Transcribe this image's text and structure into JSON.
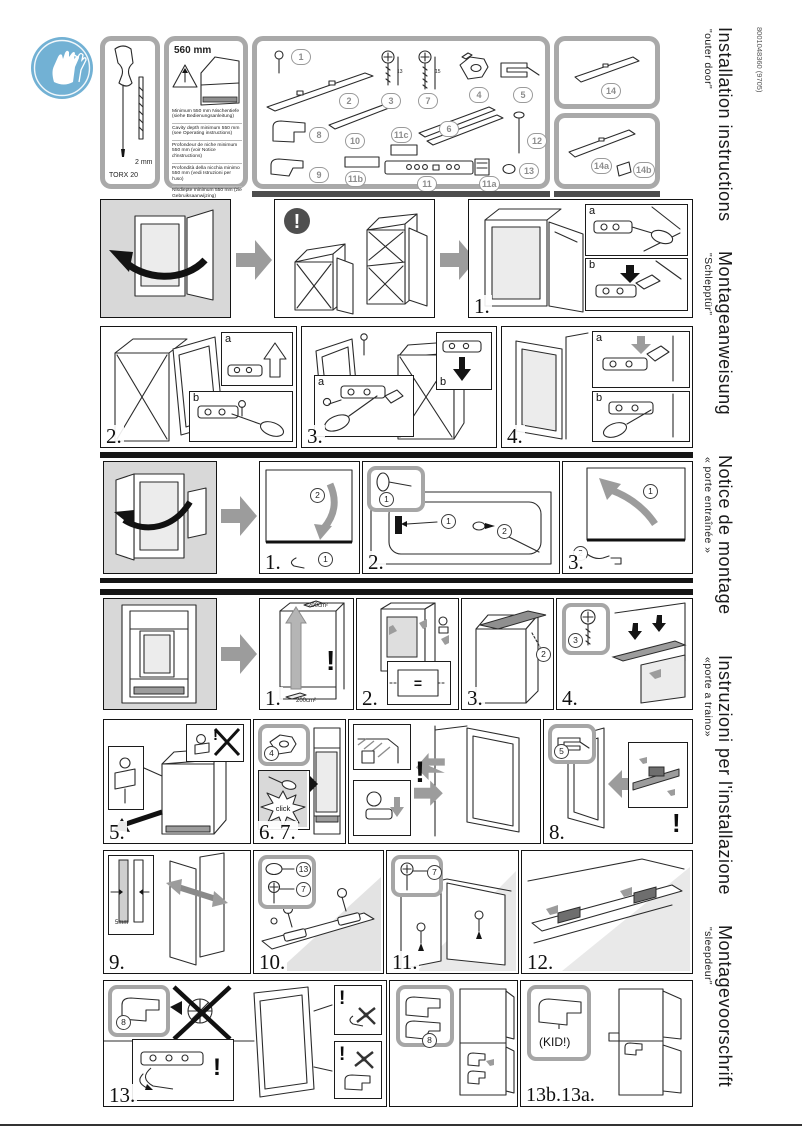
{
  "page": {
    "code": "8001048360 (9705)"
  },
  "side_titles": [
    {
      "title": "Installation instructions",
      "subtitle": "\"outer door\""
    },
    {
      "title": "Montageanweisung",
      "subtitle": "\"Schlepptür\""
    },
    {
      "title": "Notice de montage",
      "subtitle": "« porte entraînée »"
    },
    {
      "title": "Instruzioni per l'installazione",
      "subtitle": "«porte a traino»"
    },
    {
      "title": "Montagevoorschrift",
      "subtitle": "\"sleepdeur\""
    }
  ],
  "tools": {
    "torx": "TORX 20",
    "bit": "2 mm"
  },
  "cavity": {
    "width": "560 mm",
    "notes": [
      "Minimum 550 mm Nischentiefe (siehe Bedienungsanleitung)",
      "Cavity depth minimum 550 mm (see Operating instructions)",
      "Profondeur de niche minimum 550 mm (voir Notice d'instructions)",
      "Profondità della nicchia minimo 550 mm (vedi Istruzioni per l'uso)",
      "Nisdiepte minimum 550 mm (zie Gebruiksaanwijzing)"
    ]
  },
  "parts": {
    "badges": [
      "1",
      "2",
      "3",
      "7",
      "4",
      "5",
      "8",
      "10",
      "11c",
      "6",
      "12",
      "9",
      "11b",
      "11",
      "11a",
      "13"
    ],
    "right": [
      "14",
      "14a",
      "14b"
    ],
    "screw3_len": "13",
    "screw7_len": "15"
  },
  "steps": {
    "s1": "1.",
    "s2": "2.",
    "s3": "3.",
    "s4": "4.",
    "m1": "1.",
    "m2": "2.",
    "m3": "3.",
    "i1": "1.",
    "i2": "2.",
    "i3": "3.",
    "i4": "4.",
    "s5": "5.",
    "s67": "6. 7.",
    "s8": "8.",
    "s9": "9.",
    "s10": "10.",
    "s11": "11.",
    "s12": "12.",
    "s13": "13.",
    "s13ba": "13b.13a."
  },
  "annotations": {
    "a": "a",
    "b": "b",
    "c1": "1",
    "c2": "2",
    "c3": "3",
    "click": "click",
    "kid": "(KID!)",
    "gap": "5mm",
    "vent": "200cm²",
    "warn": "!",
    "equals": "="
  }
}
